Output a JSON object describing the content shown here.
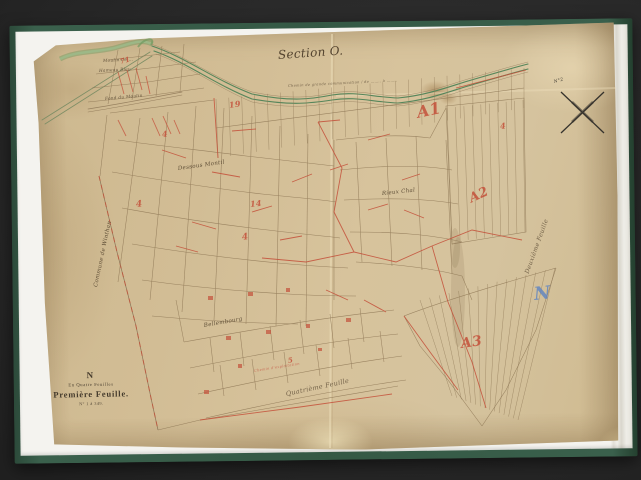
{
  "scan": {
    "background_color": "#2a2a2a",
    "cover_color": "#355944",
    "sheet_color": "#f4f3ef",
    "paper_color": "#d2bd95",
    "ink_sepia": "#8f7856",
    "ink_red": "#c4503a",
    "ink_green": "#5f8c5e",
    "ink_blue": "#5d83c2"
  },
  "map": {
    "section_title": "Section O.",
    "plate": {
      "letter": "N",
      "series": "En Quatre Feuilles",
      "title": "Première Feuille.",
      "range": "N° 1 à 349."
    },
    "labels": [
      {
        "name": "section-title",
        "text": "Section O.",
        "x": 278,
        "y": 48,
        "rot": -4,
        "fs": 12,
        "color": "#4b3b28",
        "cls": "script"
      },
      {
        "name": "road-caption",
        "text": "Chemin de grande communication / de …….. à ……..",
        "x": 288,
        "y": 84,
        "rot": -3,
        "fs": 3.6,
        "color": "#6b5a42"
      },
      {
        "name": "label-moulin",
        "text": "Moulin de …",
        "x": 103,
        "y": 58,
        "rot": -3,
        "fs": 4.2,
        "color": "#5a4a35"
      },
      {
        "name": "label-hameau-bleu",
        "text": "Hameau Bleu",
        "x": 99,
        "y": 68,
        "rot": -3,
        "fs": 4.2,
        "color": "#5a4a35"
      },
      {
        "name": "label-fond-du-moulin",
        "text": "Fond du Moulin",
        "x": 105,
        "y": 96,
        "rot": -5,
        "fs": 4.2,
        "color": "#5a4a35"
      },
      {
        "name": "label-dessous-montil",
        "text": "Dessous Montil",
        "x": 178,
        "y": 166,
        "rot": -8,
        "fs": 5.5,
        "color": "#55452f"
      },
      {
        "name": "label-rieux-chal",
        "text": "Rieux Chal",
        "x": 382,
        "y": 191,
        "rot": -6,
        "fs": 5.5,
        "color": "#55452f"
      },
      {
        "name": "label-bellembourg",
        "text": "Bellembourg",
        "x": 204,
        "y": 323,
        "rot": -10,
        "fs": 5.5,
        "color": "#55452f"
      },
      {
        "name": "label-commune-boundary",
        "text": "Commune de Winthan",
        "x": 96,
        "y": 284,
        "rot": -78,
        "fs": 5.5,
        "color": "#55452f"
      },
      {
        "name": "label-quatrieme-feuille",
        "text": "Quatrième Feuille",
        "x": 286,
        "y": 390,
        "rot": -12,
        "fs": 6.5,
        "color": "#6b5a42"
      },
      {
        "name": "label-deuxieme-feuille",
        "text": "Deuxième Feuille",
        "x": 527,
        "y": 270,
        "rot": -70,
        "fs": 6,
        "color": "#6b5a42"
      },
      {
        "name": "mark-a1",
        "text": "A1",
        "x": 417,
        "y": 103,
        "rot": -12,
        "fs": 16,
        "color": "#c4503a",
        "cls": "red"
      },
      {
        "name": "mark-a2",
        "text": "A2",
        "x": 470,
        "y": 192,
        "rot": -25,
        "fs": 13,
        "color": "#c4503a",
        "cls": "red"
      },
      {
        "name": "mark-a3",
        "text": "A3",
        "x": 461,
        "y": 336,
        "rot": -8,
        "fs": 14,
        "color": "#c4503a",
        "cls": "red"
      },
      {
        "name": "mark-71",
        "text": "71",
        "x": 120,
        "y": 57,
        "rot": -15,
        "fs": 7,
        "color": "#c4503a",
        "cls": "red"
      },
      {
        "name": "mark-4-a",
        "text": "4",
        "x": 136,
        "y": 200,
        "rot": -5,
        "fs": 9,
        "color": "#c4503a",
        "cls": "red"
      },
      {
        "name": "mark-4-b",
        "text": "4",
        "x": 242,
        "y": 233,
        "rot": -8,
        "fs": 9,
        "color": "#c4503a",
        "cls": "red"
      },
      {
        "name": "mark-4-c",
        "text": "4",
        "x": 162,
        "y": 129,
        "rot": -5,
        "fs": 8,
        "color": "#c4503a",
        "cls": "red"
      },
      {
        "name": "mark-14",
        "text": "14",
        "x": 250,
        "y": 199,
        "rot": -6,
        "fs": 8,
        "color": "#c4503a",
        "cls": "red"
      },
      {
        "name": "mark-19",
        "text": "19",
        "x": 229,
        "y": 100,
        "rot": -8,
        "fs": 8,
        "color": "#c4503a",
        "cls": "red"
      },
      {
        "name": "mark-4-d",
        "text": "4",
        "x": 500,
        "y": 121,
        "rot": -6,
        "fs": 8,
        "color": "#c4503a",
        "cls": "red"
      },
      {
        "name": "mark-5",
        "text": "5",
        "x": 288,
        "y": 356,
        "rot": -10,
        "fs": 7,
        "color": "#c4503a",
        "cls": "red"
      },
      {
        "name": "exploitation-note",
        "text": "Chemin d'exploitation",
        "x": 254,
        "y": 369,
        "rot": -9,
        "fs": 3.6,
        "color": "#c86a55"
      },
      {
        "name": "north-letter",
        "text": "N",
        "x": 534,
        "y": 284,
        "rot": -6,
        "fs": 18,
        "color": "#5d83c2",
        "cls": "blue"
      },
      {
        "name": "compass-note",
        "text": "N°2",
        "x": 554,
        "y": 80,
        "rot": -15,
        "fs": 4.5,
        "color": "#3f3a32"
      }
    ]
  }
}
